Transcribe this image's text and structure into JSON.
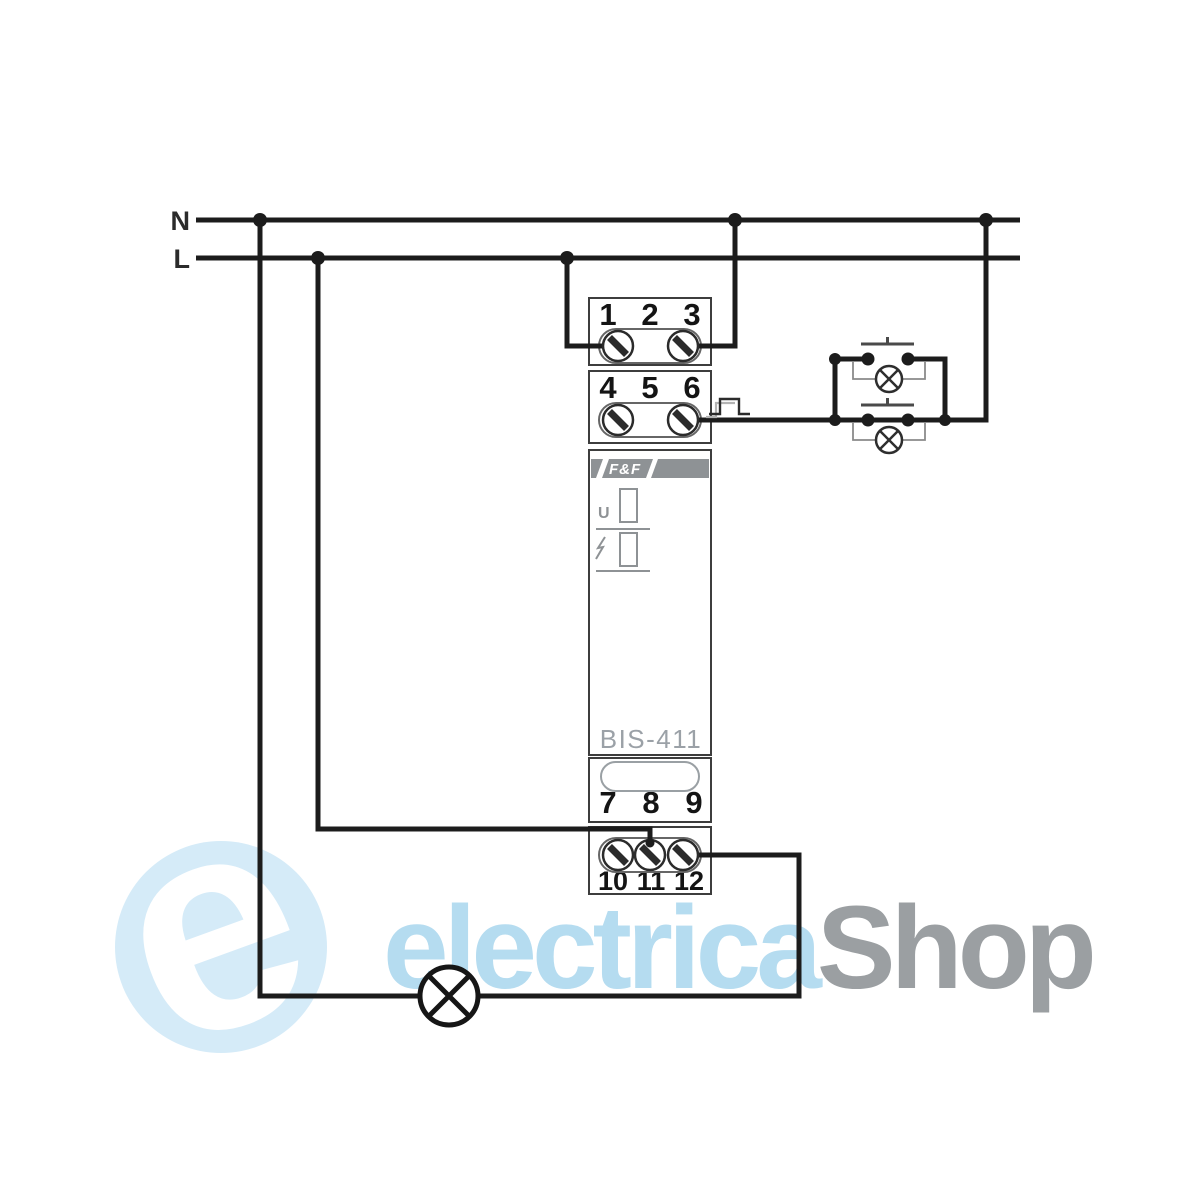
{
  "labels": {
    "neutral": "N",
    "line": "L"
  },
  "module": {
    "brand": "F&F",
    "model": "BIS-411",
    "indicator_u_label": "U",
    "terminals": {
      "row1": [
        "1",
        "2",
        "3"
      ],
      "row2": [
        "4",
        "5",
        "6"
      ],
      "row3": [
        "7",
        "8",
        "9"
      ],
      "row4": [
        "10",
        "11",
        "12"
      ]
    }
  },
  "watermark": {
    "logo_letter": "e",
    "word_primary": "electrica",
    "word_secondary": "Shop"
  },
  "colors": {
    "wire": "#1c1c1c",
    "module_outline": "#3d3d3d",
    "brand_band": "#8e9295",
    "indicator_gray": "#8e9295",
    "model_text": "#9ba1a7",
    "watermark_blue": "#b5dcf0",
    "watermark_disc_blue": "#d5ebf8",
    "watermark_gray": "#9b9fa2"
  }
}
